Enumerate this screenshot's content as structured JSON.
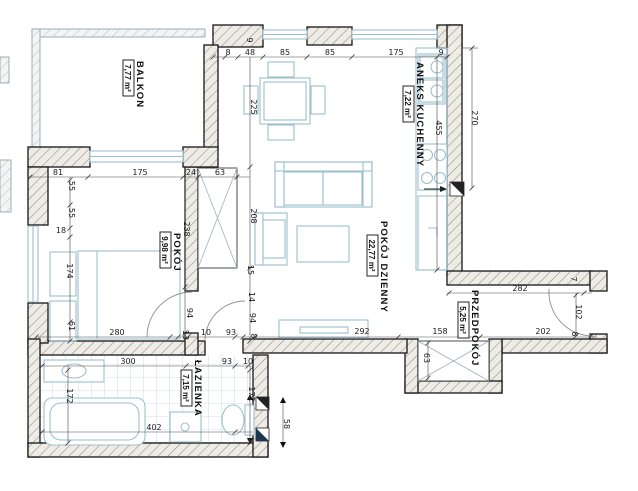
{
  "drawing": {
    "type": "apartment-floor-plan",
    "language": "pl",
    "units": "cm"
  },
  "colors": {
    "wall_line": "#161616",
    "furniture": "#9cbfce",
    "dimension_text": "#1d1d1d",
    "paper": "#ffffff",
    "vent_dark": "#1e3550"
  },
  "rooms": [
    {
      "name": "BALKON",
      "area": "7,77 m²"
    },
    {
      "name": "POKÓJ",
      "area": "9,98 m²"
    },
    {
      "name": "ANEKS KUCHENNY",
      "area": "7,22 m²"
    },
    {
      "name": "POKÓJ DZIENNY",
      "area": "22,77 m²"
    },
    {
      "name": "PRZEDPOKÓJ",
      "area": "5,25 m²"
    },
    {
      "name": "ŁAZIENKA",
      "area": "7,15 m²"
    }
  ],
  "dims": [
    "9",
    "8",
    "48",
    "85",
    "85",
    "175",
    "9",
    "270",
    "455",
    "225",
    "208",
    "81",
    "175",
    "24",
    "63",
    "55",
    "55",
    "18",
    "174",
    "61",
    "238",
    "94",
    "15",
    "14",
    "94",
    "280",
    "13",
    "10",
    "93",
    "8",
    "292",
    "158",
    "202",
    "282",
    "7",
    "102",
    "8",
    "63",
    "300",
    "93",
    "10",
    "172",
    "172",
    "402",
    "58"
  ]
}
